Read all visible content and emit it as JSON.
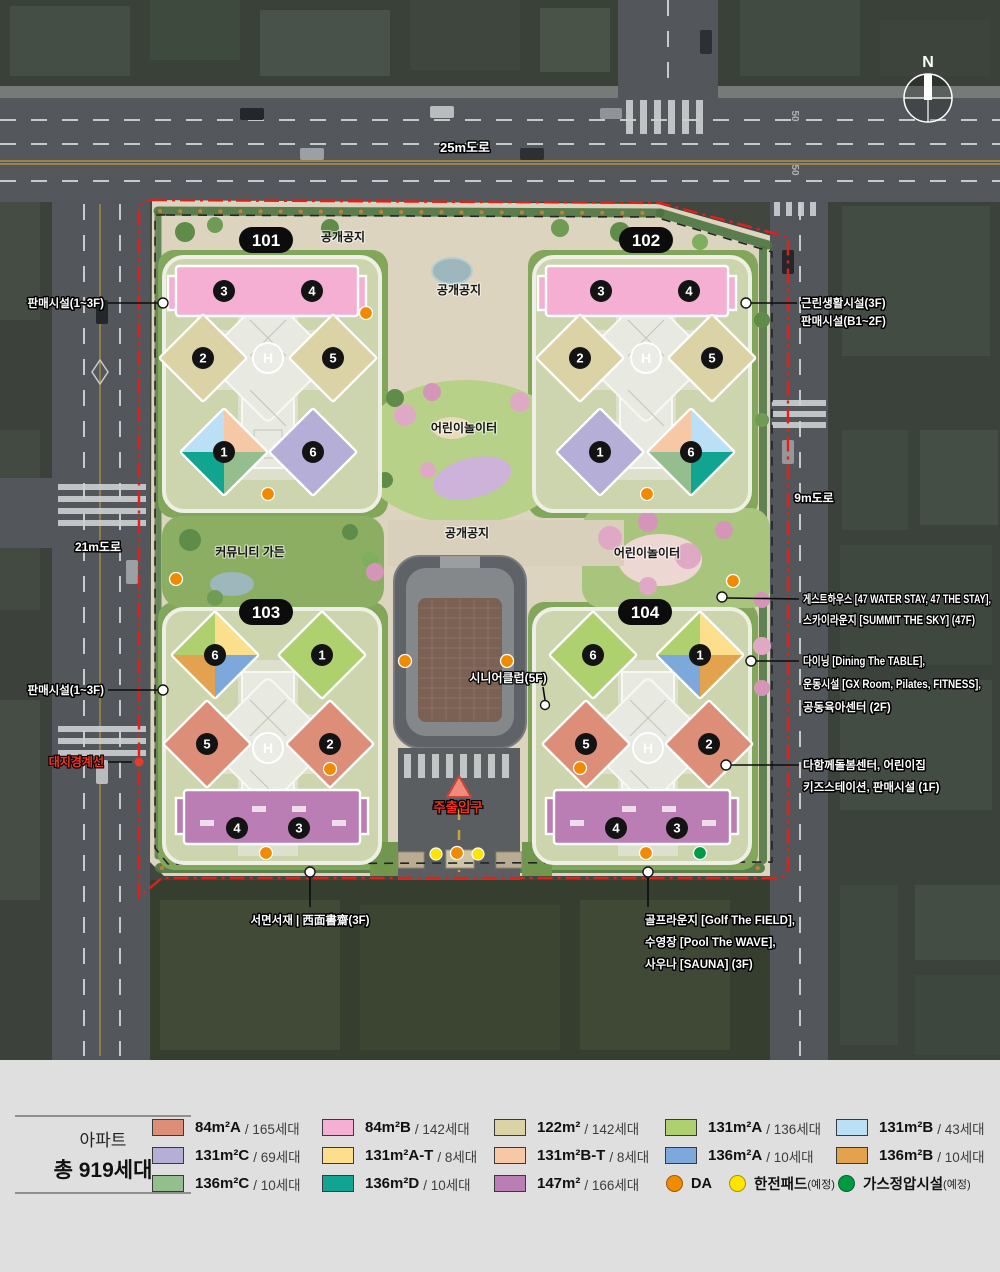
{
  "unit_colors": {
    "84A": "#DD8E78",
    "84B": "#F4AFD2",
    "122": "#DBD2A5",
    "131A": "#AFD06E",
    "131B": "#BBDFF4",
    "131C": "#B5AFD8",
    "131AT": "#FBDF8C",
    "131BT": "#F7C8A6",
    "136A": "#7CA8DB",
    "136B": "#E2A24E",
    "136C": "#94BE8D",
    "136D": "#10A491",
    "147": "#BA7DB4"
  },
  "map": {
    "compass_n": "N",
    "helipad": "H",
    "speed_mark": "50",
    "roads": {
      "top": "25m도로",
      "left": "21m도로",
      "right": "9m도로"
    },
    "badges": {
      "b101": "101",
      "b102": "102",
      "b103": "103",
      "b104": "104"
    },
    "blocks": {
      "b101": {
        "units": [
          "3",
          "4",
          "2",
          "5",
          "1",
          "6"
        ]
      },
      "b102": {
        "units": [
          "3",
          "4",
          "2",
          "5",
          "1",
          "6"
        ]
      },
      "b103": {
        "units": [
          "6",
          "1",
          "5",
          "2",
          "4",
          "3"
        ]
      },
      "b104": {
        "units": [
          "6",
          "1",
          "5",
          "2",
          "4",
          "3"
        ]
      }
    },
    "site_labels": {
      "open_space_1": "공개공지",
      "open_space_2": "공개공지",
      "open_space_3": "공개공지",
      "playground_1": "어린이놀이터",
      "playground_2": "어린이놀이터",
      "community_garden": "커뮤니티 가든",
      "senior_club": "시니어클럽(5F)",
      "main_entrance": "주출입구"
    },
    "callouts": {
      "retail_upper": "판매시설(1~3F)",
      "retail_lower": "판매시설(1~3F)",
      "site_boundary": "대지경계선",
      "neighborhood_1": "근린생활시설(3F)",
      "neighborhood_2": "판매시설(B1~2F)",
      "guesthouse_1": "게스트하우스 [47 WATER STAY, 47 THE STAY],",
      "guesthouse_2": "스카이라운지 [SUMMIT THE SKY] (47F)",
      "dining_1": "다이닝 [Dining The TABLE],",
      "dining_2": "운동시설 [GX Room, Pilates, FITNESS],",
      "dining_3": "공동육아센터 (2F)",
      "care_1": "다함께돌봄센터, 어린이집",
      "care_2": "키즈스테이션, 판매시설 (1F)",
      "study": "서면서재 | 西面書齋(3F)",
      "golf_1": "골프라운지 [Golf The FIELD],",
      "golf_2": "수영장 [Pool The WAVE],",
      "golf_3": "사우나 [SAUNA] (3F)"
    }
  },
  "legend": {
    "title_line1": "아파트",
    "title_line2": "총 919세대",
    "items": [
      {
        "area": "84m²A",
        "count": "/ 165세대"
      },
      {
        "area": "131m²C",
        "count": "/ 69세대"
      },
      {
        "area": "136m²C",
        "count": "/ 10세대"
      },
      {
        "area": "84m²B",
        "count": "/ 142세대"
      },
      {
        "area": "131m²A-T",
        "count": "/ 8세대"
      },
      {
        "area": "136m²D",
        "count": "/ 10세대"
      },
      {
        "area": "122m²",
        "count": "/ 142세대"
      },
      {
        "area": "131m²B-T",
        "count": "/ 8세대"
      },
      {
        "area": "147m²",
        "count": "/ 166세대"
      },
      {
        "area": "131m²A",
        "count": "/ 136세대"
      },
      {
        "area": "136m²A",
        "count": "/ 10세대"
      },
      {
        "area": "131m²B",
        "count": "/ 43세대"
      },
      {
        "area": "136m²B",
        "count": "/ 10세대"
      }
    ],
    "markers": {
      "da": {
        "label": "DA",
        "color": "#F08A00"
      },
      "pad": {
        "label": "한전패드",
        "note": "(예정)",
        "color": "#FFE400"
      },
      "gas": {
        "label": "가스정압시설",
        "note": "(예정)",
        "color": "#009A44"
      }
    }
  }
}
